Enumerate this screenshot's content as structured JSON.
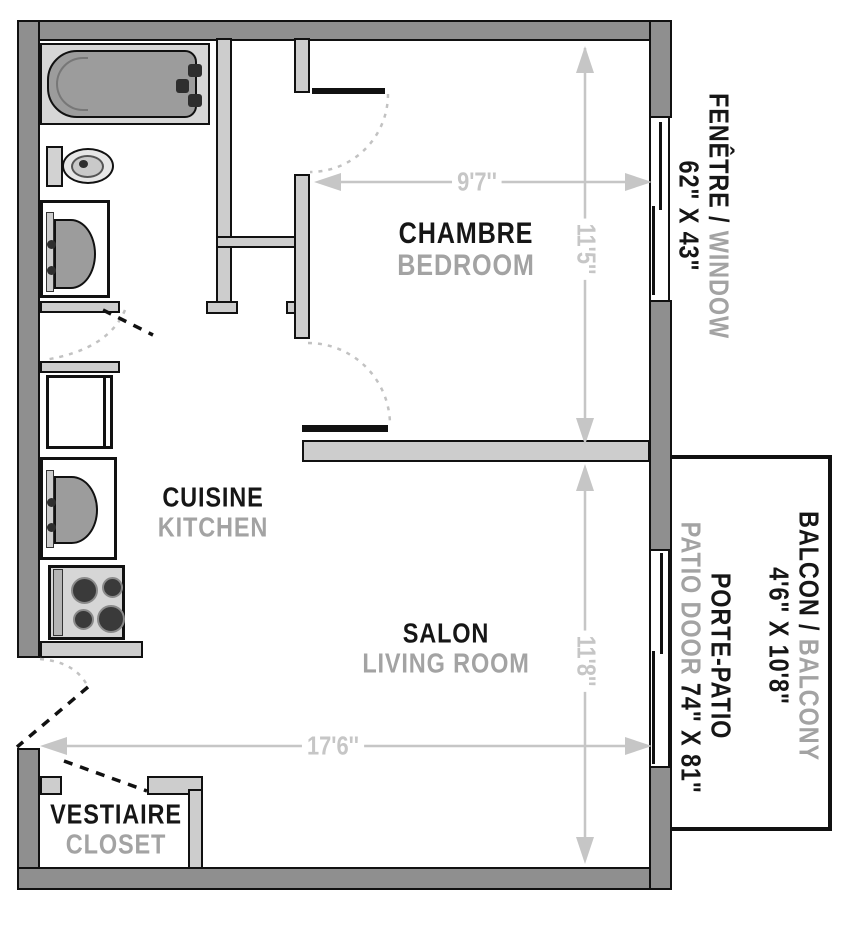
{
  "rooms": [
    {
      "primary": "CHAMBRE",
      "secondary": "BEDROOM"
    },
    {
      "primary": "CUISINE",
      "secondary": "KITCHEN"
    },
    {
      "primary": "SALON",
      "secondary": "LIVING ROOM"
    },
    {
      "primary": "VESTIAIRE",
      "secondary": "CLOSET"
    }
  ],
  "features": {
    "window": {
      "fr": "FENÊTRE / ",
      "en": "WINDOW",
      "size": "62\" X 43\""
    },
    "balcony": {
      "fr": "BALCON / ",
      "en": "BALCONY",
      "size": "4'6\" X 10'8\""
    },
    "patio_door": {
      "fr": "PORTE-PATIO",
      "en": "PATIO DOOR ",
      "size": "74\" X 81\""
    }
  },
  "dimensions": {
    "bedroom_width": "9'7''",
    "bedroom_depth": "11'5''",
    "living_depth": "11'8''",
    "living_width": "17'6''"
  },
  "fixtures": [
    "bathtub",
    "toilet",
    "bathroom-sink",
    "refrigerator",
    "kitchen-sink",
    "stove"
  ],
  "colors": {
    "wall_outer": "#8f8f8f",
    "wall_inner": "#cdcdcd",
    "fixture_basin": "#9c9c9c",
    "dimension_gray": "#c6c6c6",
    "label_primary": "#161616",
    "label_secondary": "#a3a3a3"
  }
}
